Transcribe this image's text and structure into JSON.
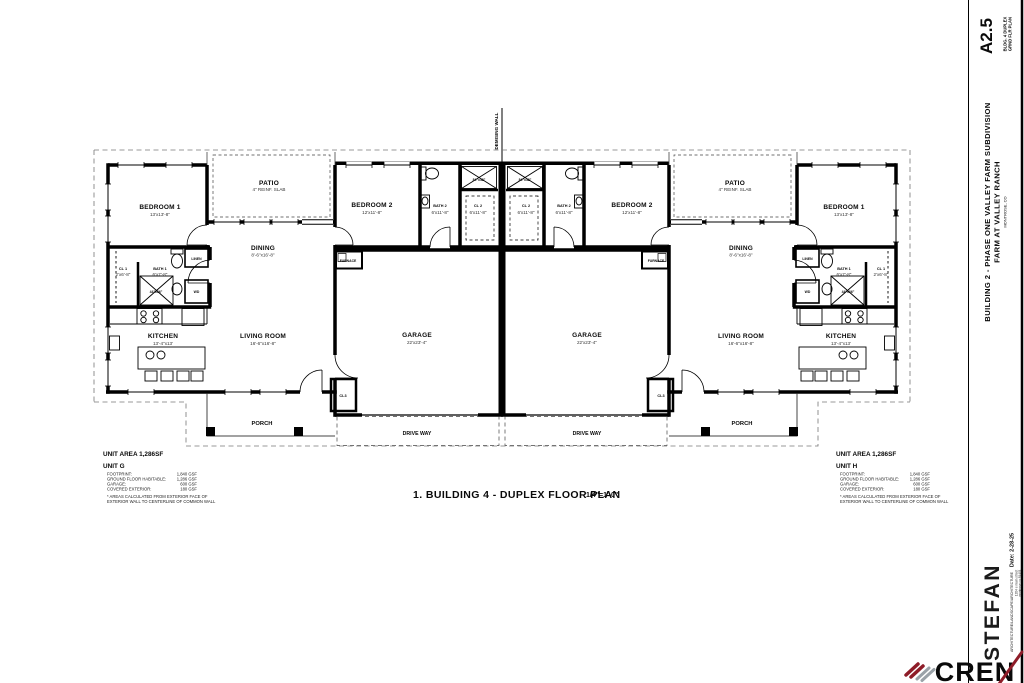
{
  "sheet": {
    "number": "A2.5",
    "number_sub1": "BLDG. 4 DUPLEX",
    "number_sub2": "GRND FLR PLAN",
    "project_line1": "BUILDING 2 - PHASE ONE VALLEY FARM SUBDIVISION",
    "project_line2": "FARM AT VALLEY RANCH",
    "project_line3": "MONTROSE, CO",
    "date_label": "Date: 2-28-25"
  },
  "drawing_title": {
    "text": "1. BUILDING 4 - DUPLEX FLOOR PLAN",
    "scale": "1/4\"=1'-0\""
  },
  "annotations": {
    "demising_wall": "DEMISING WALL"
  },
  "rooms": {
    "bedroom1": {
      "label": "BEDROOM 1",
      "dim": "13'x13'-8\""
    },
    "bedroom2": {
      "label": "BEDROOM 2",
      "dim": "12'x11'-8\""
    },
    "bath1": {
      "label": "BATH 1",
      "dim": "6'x7'-8\""
    },
    "bath2": {
      "label": "BATH 2",
      "dim": "6'x11'-8\""
    },
    "cl1": {
      "label": "CL 1",
      "dim": "2'x6'-8\""
    },
    "cl2": {
      "label": "CL 2",
      "dim": "6'x11'-8\""
    },
    "cl3": {
      "label": "CL3"
    },
    "dining": {
      "label": "DINING",
      "dim": "8'-6\"x16'-8\""
    },
    "kitchen": {
      "label": "KITCHEN",
      "dim": "13'-4\"x13'"
    },
    "living": {
      "label": "LIVING ROOM",
      "dim": "16'-6\"x16'-8\""
    },
    "garage": {
      "label": "GARAGE",
      "dim": "22'x23'-4\""
    },
    "patio": {
      "label": "PATIO",
      "note": "4\" REINF. SLAB"
    },
    "porch": {
      "label": "PORCH"
    },
    "driveway": {
      "label": "DRIVE WAY"
    },
    "furnace": {
      "label": "FURNACE"
    },
    "linen": {
      "label": "LINEN"
    },
    "wd": {
      "label": "WD"
    },
    "shower_large": {
      "label": "84\"x48\""
    },
    "shower_small": {
      "label": "44\"x36\""
    }
  },
  "unit_g": {
    "area": "UNIT AREA 1,286SF",
    "name": "UNIT G",
    "row1_label": "FOOTPRINT:",
    "row1_value": "1,840 GSF",
    "row2_label": "GROUND FLOOR HABITABLE:",
    "row2_value": "1,286 GSF",
    "row3_label": "GARAGE:",
    "row3_value": "600 GSF",
    "row4_label": "COVERED EXTERIOR:",
    "row4_value": "180 GSF",
    "note1": "* AREAS CALCULATED FROM EXTERIOR FACE OF",
    "note2": "EXTERIOR WALL TO CENTERLINE OF COMMON WALL"
  },
  "unit_h": {
    "area": "UNIT AREA 1,286SF",
    "name": "UNIT H",
    "row1_label": "FOOTPRINT:",
    "row1_value": "1,840 GSF",
    "row2_label": "GROUND FLOOR HABITABLE:",
    "row2_value": "1,286 GSF",
    "row3_label": "GARAGE:",
    "row3_value": "600 GSF",
    "row4_label": "COVERED EXTERIOR:",
    "row4_value": "180 GSF",
    "note1": "* AREAS CALCULATED FROM EXTERIOR FACE OF",
    "note2": "EXTERIOR WALL TO CENTERLINE OF COMMON WALL"
  },
  "firm": {
    "name": "STEFAN",
    "tagline": "ARCHITECTURE/LANDSCAPE/ARCHITECTURE",
    "address1": "1204 e main street",
    "address2": "montrose co 81401"
  },
  "logo": {
    "text": "CREN"
  },
  "colors": {
    "cren_red": "#8e1c28",
    "cren_gray": "#9aa2a8",
    "wall_black": "#000000"
  }
}
